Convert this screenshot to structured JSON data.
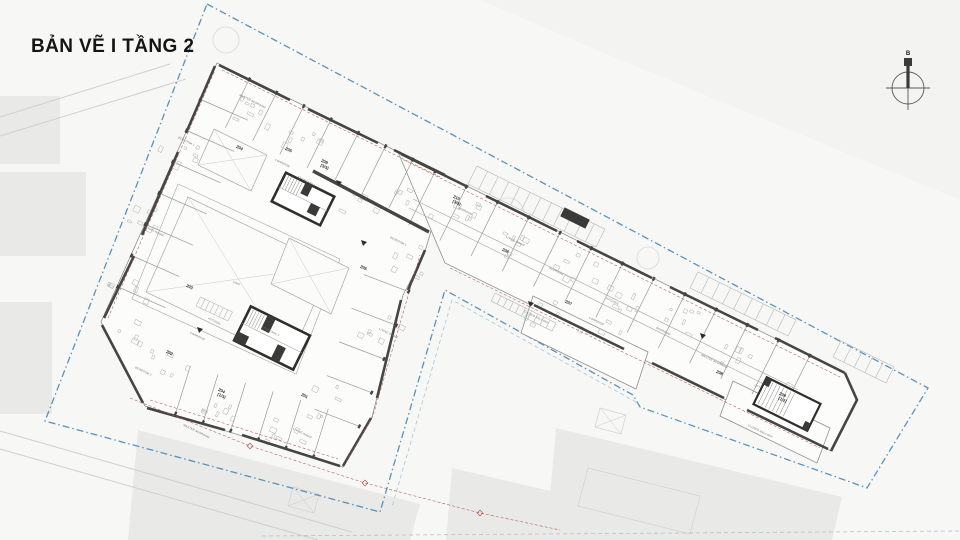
{
  "title": "BẢN VẼ I TẦNG 2",
  "compass": {
    "letter": "B"
  },
  "colors": {
    "paper": "#f7f7f5",
    "boundary": "#4e8dbc",
    "wall": "#454543",
    "wall_light": "#9a9a98",
    "red": "#b2574f",
    "building_fill": "#fcfcfb",
    "context": "#e9e9e7",
    "hatch": "#b6b6b4"
  },
  "plan": {
    "unit_labels": [
      {
        "text": "204",
        "x": 239,
        "y": 149
      },
      {
        "text": "205",
        "x": 288,
        "y": 151
      },
      {
        "text": "209",
        "x": 324,
        "y": 163
      },
      {
        "text": "(3/3)",
        "x": 324,
        "y": 168
      },
      {
        "text": "210",
        "x": 456,
        "y": 199
      },
      {
        "text": "(3/3)",
        "x": 456,
        "y": 204
      },
      {
        "text": "206",
        "x": 505,
        "y": 252
      },
      {
        "text": "207",
        "x": 568,
        "y": 304
      },
      {
        "text": "208",
        "x": 719,
        "y": 374
      },
      {
        "text": "209",
        "x": 782,
        "y": 396
      },
      {
        "text": "(1/2)",
        "x": 782,
        "y": 401
      },
      {
        "text": "203",
        "x": 189,
        "y": 288
      },
      {
        "text": "202",
        "x": 169,
        "y": 354
      },
      {
        "text": "204",
        "x": 221,
        "y": 392
      },
      {
        "text": "(1/3)",
        "x": 221,
        "y": 397
      },
      {
        "text": "201",
        "x": 304,
        "y": 397
      },
      {
        "text": "205",
        "x": 363,
        "y": 269
      }
    ],
    "room_labels": [
      {
        "text": "CORRIDOR",
        "x": 282,
        "y": 164
      },
      {
        "text": "CORRIDOR",
        "x": 197,
        "y": 337
      },
      {
        "text": "CORRIDOR",
        "x": 596,
        "y": 322
      },
      {
        "text": "STAIRCASE 1",
        "x": 306,
        "y": 182
      },
      {
        "text": "STAIRCASE 2",
        "x": 270,
        "y": 332
      },
      {
        "text": "LIFT",
        "x": 757,
        "y": 387
      },
      {
        "text": "VOID",
        "x": 236,
        "y": 284
      },
      {
        "text": "MASTER BEDROOM",
        "x": 252,
        "y": 102
      },
      {
        "text": "BEDROOM 1",
        "x": 186,
        "y": 142
      },
      {
        "text": "LIVING ROOM",
        "x": 154,
        "y": 232
      },
      {
        "text": "KITCHEN",
        "x": 214,
        "y": 322
      },
      {
        "text": "BEDROOM 2",
        "x": 143,
        "y": 372
      },
      {
        "text": "MASTER BEDROOM",
        "x": 196,
        "y": 432
      },
      {
        "text": "LIVING ROOM",
        "x": 302,
        "y": 434
      },
      {
        "text": "BEDROOM 1",
        "x": 398,
        "y": 242
      },
      {
        "text": "LIVING ROOM",
        "x": 388,
        "y": 334
      },
      {
        "text": "BEDROOM",
        "x": 465,
        "y": 212
      },
      {
        "text": "LIVING ROOM",
        "x": 515,
        "y": 242
      },
      {
        "text": "BEDROOM",
        "x": 556,
        "y": 272
      },
      {
        "text": "KITCHEN",
        "x": 612,
        "y": 302
      },
      {
        "text": "BEDROOM",
        "x": 663,
        "y": 332
      },
      {
        "text": "MASTER BEDROOM",
        "x": 714,
        "y": 362
      },
      {
        "text": "CLOSED BALCONY",
        "x": 536,
        "y": 318
      },
      {
        "text": "CLOSED BALCONY",
        "x": 760,
        "y": 432
      }
    ]
  }
}
